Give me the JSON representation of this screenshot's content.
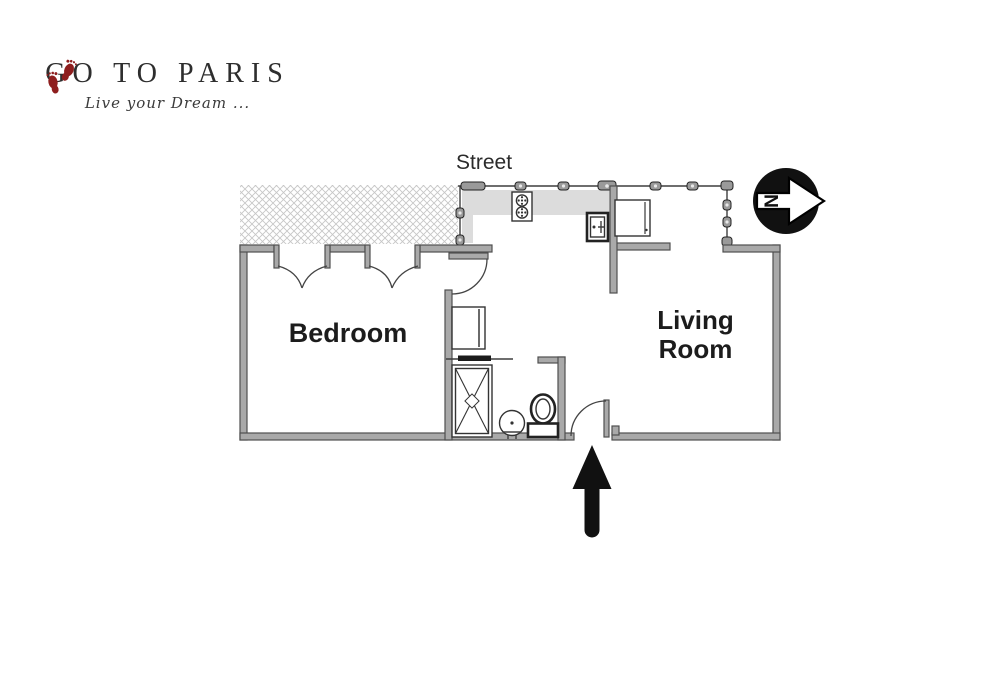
{
  "logo": {
    "title": "GO TO PARIS",
    "tagline": "Live your Dream ...",
    "icon": "footprints-icon"
  },
  "plan": {
    "street_label": "Street",
    "rooms": [
      {
        "name": "Bedroom"
      },
      {
        "name": "Living Room"
      }
    ],
    "compass": {
      "letter": "N",
      "points": "right"
    },
    "entrance_arrow_direction": "up",
    "fixtures": [
      "stove-icon",
      "kitchen-sink-icon",
      "refrigerator-icon",
      "washer-icon",
      "shower-icon",
      "washbasin-icon",
      "toilet-icon"
    ],
    "features": [
      "hatched-neighbor-area",
      "street-window-band",
      "double-french-doors-bedroom",
      "kitchen-door",
      "bathroom-sliding-door",
      "entry-door"
    ]
  },
  "colors": {
    "logo-red": "#8e1e1e",
    "title-text": "#2e2e2e",
    "plan-line": "#3f3f3f",
    "wall-fill": "#a9a9a9",
    "wall-stroke": "#4f4f4f",
    "counter-gray": "#dcdcdc",
    "hatch-gray": "#c6c6c6",
    "label-text": "#1c1c1c",
    "arrow-black": "#111111"
  }
}
